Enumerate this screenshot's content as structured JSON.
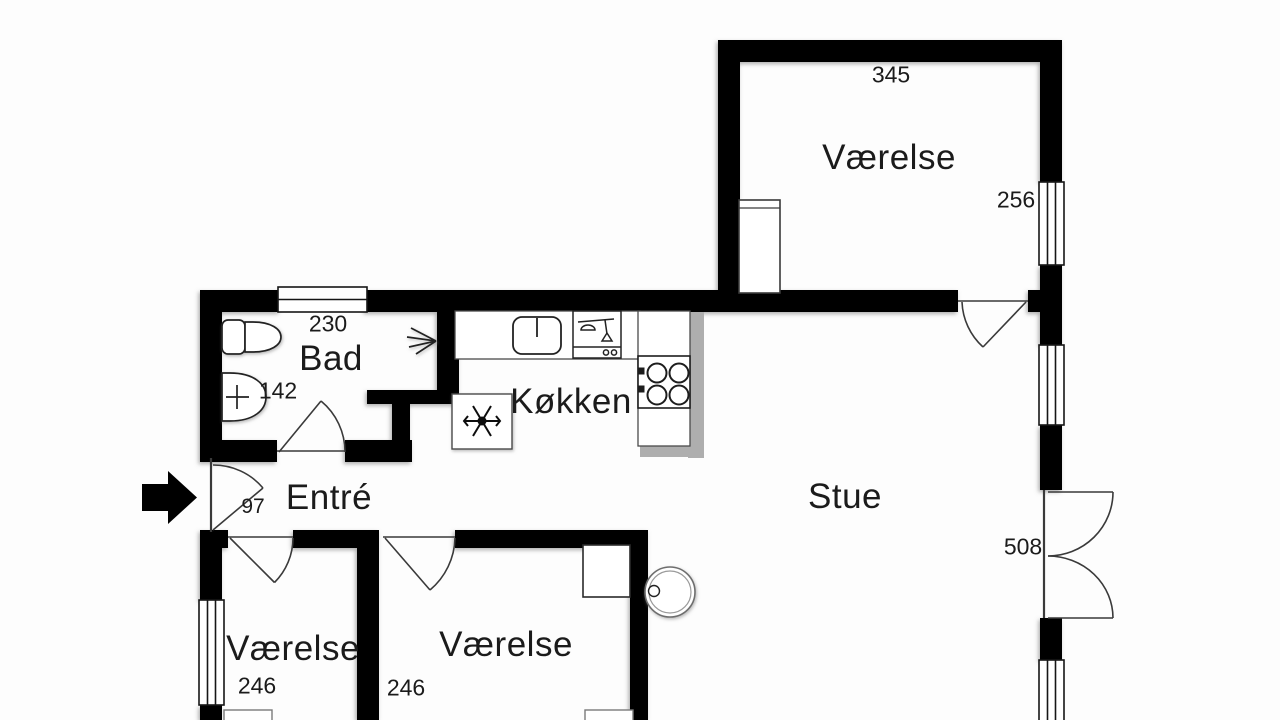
{
  "plan": {
    "title": "Apartment floor plan",
    "colors": {
      "wall": "#000000",
      "background": "#fdfdfd",
      "fixture_stroke": "#2a2a2a",
      "counter_shadow": "#aeaeae",
      "text": "#1b1b1b"
    },
    "rooms": [
      {
        "id": "vaerelse-ne",
        "label": "Værelse",
        "dim_top": "345",
        "dim_right": "256"
      },
      {
        "id": "bad",
        "label": "Bad",
        "dim_top": "230",
        "dim_left": "142"
      },
      {
        "id": "koekken",
        "label": "Køkken"
      },
      {
        "id": "entre",
        "label": "Entré",
        "dim_door": "97"
      },
      {
        "id": "stue",
        "label": "Stue",
        "dim_door": "508"
      },
      {
        "id": "vaerelse-sw",
        "label": "Værelse",
        "dim": "246"
      },
      {
        "id": "vaerelse-s",
        "label": "Værelse",
        "dim": "246"
      }
    ],
    "fixtures": [
      "entrance-arrow",
      "toilet",
      "washbasin",
      "shower-spray",
      "kitchen-sink",
      "dishwasher",
      "stove",
      "fridge-snowflake",
      "round-table",
      "wardrobe-ne",
      "wardrobe-s",
      "radiator-sw",
      "radiator-s",
      "window-bad",
      "window-ne",
      "window-stue-upper",
      "window-stue-lower",
      "window-sw",
      "door-entrance",
      "door-bad",
      "door-vaerelse-ne",
      "door-vaerelse-sw",
      "door-vaerelse-s",
      "french-doors-stue"
    ]
  }
}
